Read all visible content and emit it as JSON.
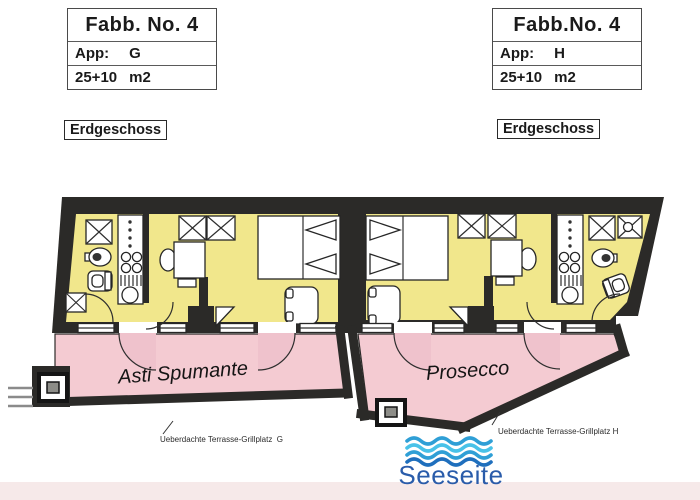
{
  "colors": {
    "room": "#f1e78c",
    "terrace": "#f4cbd2",
    "terrace_shade": "#efc2cc",
    "wall": "#2b2a28",
    "lake-text": "#2a5caa",
    "wave-light": "#49c2e8",
    "wave-mid": "#2f9fd6",
    "wave-dark": "#1f6fbd"
  },
  "info_boxes": {
    "left": {
      "title": "Fabb. No. 4",
      "app_label": "App:",
      "app_value": "G",
      "area": "25+10",
      "area_unit": "m2"
    },
    "right": {
      "title": "Fabb.No. 4",
      "app_label": "App:",
      "app_value": "H",
      "area": "25+10",
      "area_unit": "m2"
    }
  },
  "floor_labels": {
    "left": "Erdgeschoss",
    "right": "Erdgeschoss"
  },
  "terraces": {
    "left": {
      "name": "Asti Spumante",
      "caption": "Ueberdachte Terrasse-Grillplatz  G"
    },
    "right": {
      "name": "Prosecco",
      "caption": "Ueberdachte Terrasse-Grillplatz H"
    }
  },
  "waterside": {
    "label": "Seeseite",
    "icon": "waves-icon"
  }
}
